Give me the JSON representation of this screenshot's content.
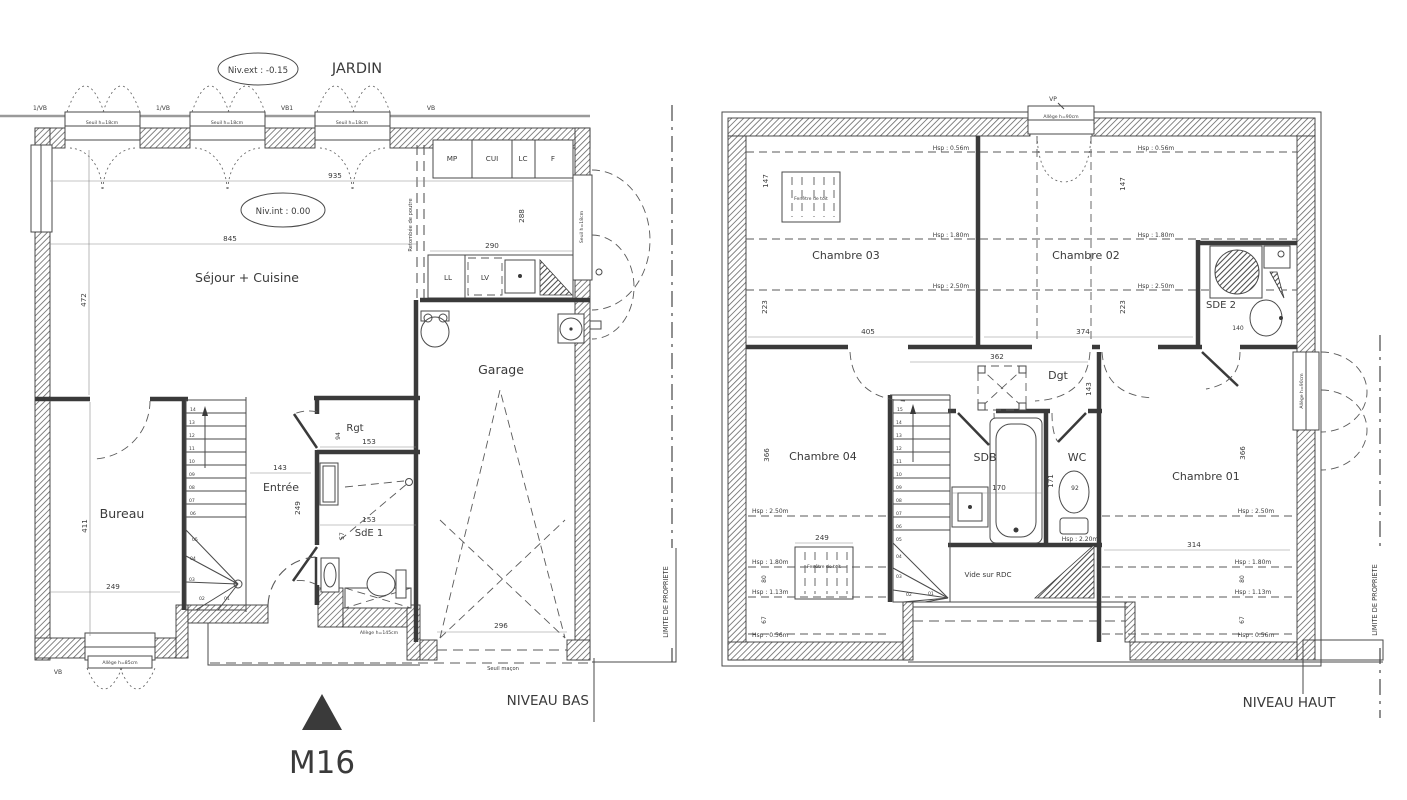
{
  "ground_floor": {
    "title": "NIVEAU BAS",
    "compass": "M16",
    "garden": "JARDIN",
    "level_ext": "Niv.ext : -0.15",
    "level_int": "Niv.int : 0.00",
    "rooms": {
      "sejour": "Séjour + Cuisine",
      "bureau": "Bureau",
      "entree": "Entrée",
      "garage": "Garage",
      "rgt": "Rgt",
      "sde1": "SdE 1"
    },
    "kitchen": {
      "mp": "MP",
      "cui": "CUI",
      "lc": "LC",
      "f": "F",
      "ll": "LL",
      "lv": "LV"
    },
    "annotations": {
      "sill_top": "Seuil h=18cm",
      "door_sill": "Seuil h=18cm",
      "allege85": "Allège h=85cm",
      "allege145": "Allège h=145cm",
      "seuil_macon": "Seuil maçon",
      "beam": "Retombée de poutre",
      "vb1": "1/VB",
      "vb2": "1/VB",
      "vb3": "VB1",
      "vb4": "VB",
      "vb5": "VB"
    },
    "dims": {
      "d935": "935",
      "d845": "845",
      "d290": "290",
      "d288": "288",
      "d472": "472",
      "d411": "411",
      "d249": "249",
      "d143": "143",
      "d153": "153",
      "d94": "94",
      "d57": "57",
      "d296": "296"
    },
    "stairs": [
      "01",
      "02",
      "03",
      "04",
      "05",
      "06",
      "07",
      "08",
      "09",
      "10",
      "11",
      "12",
      "13",
      "14"
    ]
  },
  "upper_floor": {
    "title": "NIVEAU HAUT",
    "rooms": {
      "ch01": "Chambre 01",
      "ch02": "Chambre 02",
      "ch03": "Chambre 03",
      "ch04": "Chambre 04",
      "sdb": "SDB",
      "wc": "WC",
      "sde2": "SDE 2",
      "dgt": "Dgt",
      "vide": "Vide sur RDC"
    },
    "annotations": {
      "vp": "VP",
      "allege90": "Allège h=90cm",
      "roof_window": "Fenêtre de toit",
      "property": "LIMITE DE PROPRIETE",
      "hsp056": "Hsp : 0.56m",
      "hsp113": "Hsp : 1.13m",
      "hsp180": "Hsp : 1.80m",
      "hsp220": "Hsp : 2.20m",
      "hsp250": "Hsp : 2.50m"
    },
    "dims": {
      "d147": "147",
      "d223": "223",
      "d405": "405",
      "d374": "374",
      "d362": "362",
      "d143": "143",
      "d366": "366",
      "d249": "249",
      "d170": "170",
      "d171": "171",
      "d92": "92",
      "d314": "314",
      "d80": "80",
      "d67": "67",
      "d140": "140"
    },
    "stairs": [
      "01",
      "02",
      "03",
      "04",
      "05",
      "06",
      "07",
      "08",
      "09",
      "10",
      "11",
      "12",
      "13",
      "14",
      "15"
    ]
  }
}
